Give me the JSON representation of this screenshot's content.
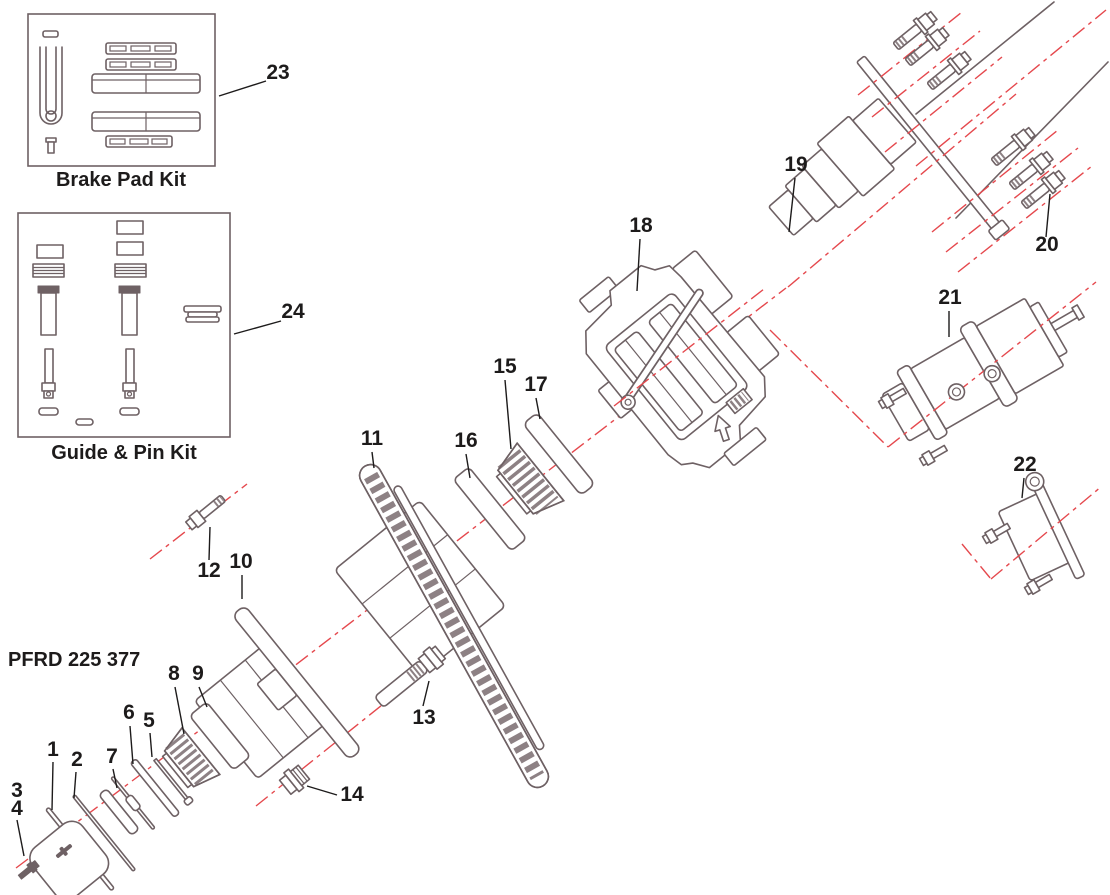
{
  "diagram": {
    "code": "PFRD 225 377",
    "kits": [
      {
        "callout": "23",
        "title": "Brake Pad Kit"
      },
      {
        "callout": "24",
        "title": "Guide & Pin Kit"
      }
    ],
    "parts": [
      {
        "number": "1"
      },
      {
        "number": "2"
      },
      {
        "number": "3"
      },
      {
        "number": "4"
      },
      {
        "number": "5"
      },
      {
        "number": "6"
      },
      {
        "number": "7"
      },
      {
        "number": "8"
      },
      {
        "number": "9"
      },
      {
        "number": "10"
      },
      {
        "number": "11"
      },
      {
        "number": "12"
      },
      {
        "number": "13"
      },
      {
        "number": "14"
      },
      {
        "number": "15"
      },
      {
        "number": "16"
      },
      {
        "number": "17"
      },
      {
        "number": "18"
      },
      {
        "number": "19"
      },
      {
        "number": "20"
      },
      {
        "number": "21"
      },
      {
        "number": "22"
      }
    ]
  },
  "colors": {
    "line_art": "#6e6164",
    "centerline_red": "#e5484d",
    "label_text": "#1d1b1b",
    "background": "#ffffff"
  }
}
